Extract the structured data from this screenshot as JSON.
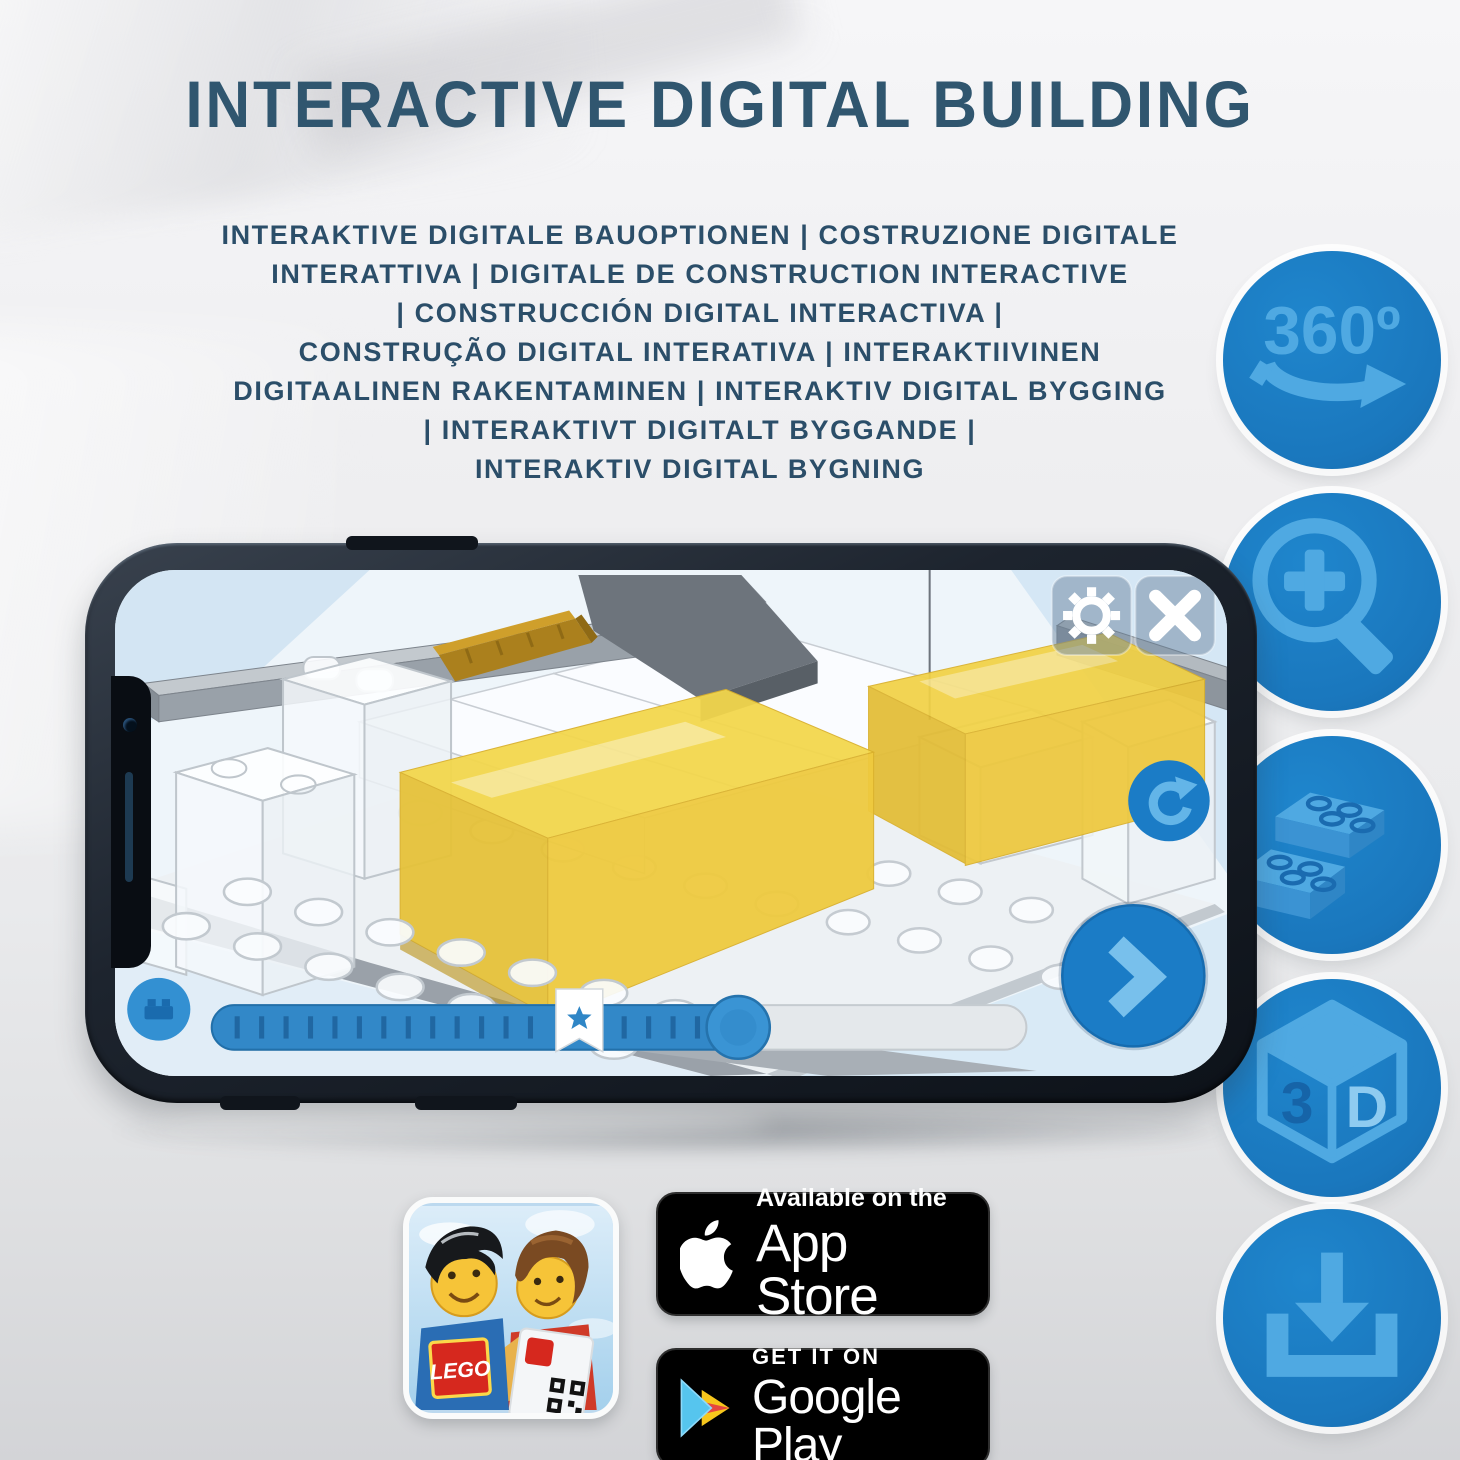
{
  "title": "INTERACTIVE DIGITAL BUILDING",
  "subtitle_lines": [
    "INTERAKTIVE DIGITALE BAUOPTIONEN | COSTRUZIONE DIGITALE",
    "INTERATTIVA | DIGITALE DE CONSTRUCTION INTERACTIVE",
    "| CONSTRUCCIÓN DIGITAL INTERACTIVA |",
    "CONSTRUÇÃO DIGITAL INTERATIVA | INTERAKTIIVINEN",
    "DIGITAALINEN RAKENTAMINEN | INTERAKTIV DIGITAL BYGGING",
    "| INTERAKTIVT DIGITALT BYGGANDE |",
    "INTERAKTIV DIGITAL BYGNING"
  ],
  "feature_icons": {
    "items": [
      {
        "icon": "360-rotation-icon",
        "label": "360º"
      },
      {
        "icon": "zoom-in-icon"
      },
      {
        "icon": "brick-options-icon"
      },
      {
        "icon": "3d-cube-icon",
        "face_left": "3",
        "face_right": "D"
      },
      {
        "icon": "download-icon"
      }
    ]
  },
  "badges": {
    "app_store": {
      "tagline": "Available on the",
      "store": "App Store"
    },
    "google_play": {
      "tagline": "GET IT ON",
      "store": "Google Play"
    }
  },
  "app_icon": {
    "brand": "LEGO"
  },
  "colors": {
    "accent_blue": "#1a7dc5",
    "icon_light_blue": "#56aee6",
    "title_blue": "#30566f",
    "highlight_yellow": "#f0cf3a",
    "badge_black": "#000000"
  }
}
